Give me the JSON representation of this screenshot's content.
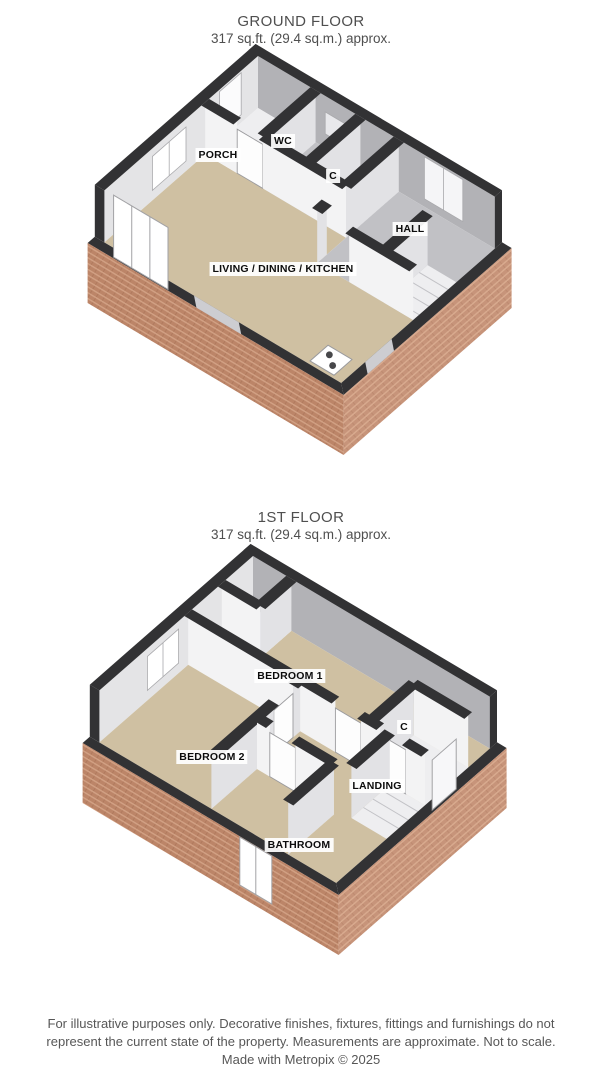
{
  "ground_floor": {
    "title": "GROUND FLOOR",
    "subtitle": "317 sq.ft. (29.4 sq.m.) approx.",
    "labels": [
      {
        "text": "PORCH",
        "x": 218,
        "y": 155
      },
      {
        "text": "WC",
        "x": 283,
        "y": 141
      },
      {
        "text": "C",
        "x": 333,
        "y": 176
      },
      {
        "text": "HALL",
        "x": 410,
        "y": 229
      },
      {
        "text": "LIVING / DINING / KITCHEN",
        "x": 283,
        "y": 269
      }
    ]
  },
  "first_floor": {
    "title": "1ST FLOOR",
    "subtitle": "317 sq.ft. (29.4 sq.m.) approx.",
    "labels": [
      {
        "text": "BEDROOM 1",
        "x": 290,
        "y": 676
      },
      {
        "text": "BEDROOM 2",
        "x": 212,
        "y": 757
      },
      {
        "text": "C",
        "x": 404,
        "y": 727
      },
      {
        "text": "LANDING",
        "x": 377,
        "y": 786
      },
      {
        "text": "BATHROOM",
        "x": 299,
        "y": 845
      }
    ]
  },
  "footer": {
    "line1": "For illustrative purposes only. Decorative finishes, fixtures, fittings and furnishings do not",
    "line2": "represent the current state of the property. Measurements are approximate. Not to scale.",
    "line3": "Made with Metropix © 2025"
  },
  "colors": {
    "dark": "#323234",
    "tan": "#cfc0a2",
    "floorGray": "#c1c1c5",
    "floorWhite": "#eeeef0",
    "neFace": "#b2b2b6",
    "nwFace": "#e4e4e6",
    "wallH": "#f3f3f4",
    "wallV": "#e2e2e5",
    "brickBase": "#c7947a",
    "brickLight": "#d9ab8f"
  },
  "plans": {
    "ground": {
      "origin": [
        258,
        108
      ],
      "size": [
        7.4,
        6.4
      ],
      "floors": [
        {
          "pts": [
            [
              0,
              2.2
            ],
            [
              4.4,
              2.2
            ],
            [
              4.4,
              3.4
            ],
            [
              7.4,
              3.4
            ],
            [
              7.4,
              6.4
            ],
            [
              0,
              6.4
            ]
          ],
          "fill": "tan"
        },
        {
          "pts": [
            [
              0,
              0
            ],
            [
              1.8,
              0
            ],
            [
              1.8,
              2.2
            ],
            [
              0,
              2.2
            ]
          ],
          "fill": "floorWhite"
        },
        {
          "pts": [
            [
              1.8,
              0
            ],
            [
              3.2,
              0
            ],
            [
              3.2,
              2.2
            ],
            [
              1.8,
              2.2
            ]
          ],
          "fill": "floorGray"
        },
        {
          "pts": [
            [
              3.2,
              0
            ],
            [
              4.4,
              0
            ],
            [
              4.4,
              2.2
            ],
            [
              3.2,
              2.2
            ]
          ],
          "fill": "floorGray"
        },
        {
          "pts": [
            [
              4.4,
              0
            ],
            [
              7.4,
              0
            ],
            [
              7.4,
              3.4
            ],
            [
              4.4,
              3.4
            ]
          ],
          "fill": "floorGray"
        },
        {
          "pts": [
            [
              6.5,
              1.6
            ],
            [
              7.4,
              1.6
            ],
            [
              7.4,
              3.4
            ],
            [
              6.5,
              3.4
            ]
          ],
          "fill": "floorWhite"
        }
      ],
      "treads": {
        "u1": 6.5,
        "u2": 7.4,
        "vs": [
          1.95,
          2.35,
          2.75,
          3.15
        ]
      },
      "insets": [
        {
          "wall": "NW",
          "f": 0.7,
          "t": 1.6,
          "y1": 50,
          "y2": 8,
          "fill": "#fbfbfc",
          "panes": 1
        },
        {
          "wall": "NW",
          "f": 3.0,
          "t": 4.4,
          "y1": 44,
          "y2": 10,
          "fill": "#ffffff",
          "panes": 2
        },
        {
          "wall": "NE",
          "f": 2.1,
          "t": 2.9,
          "y1": 36,
          "y2": 14,
          "fill": "#e8e8eb",
          "panes": 1
        },
        {
          "wall": "NE",
          "f": 5.2,
          "t": 6.4,
          "y1": 50,
          "y2": 8,
          "fill": "#f5f5f7",
          "panes": 2
        }
      ],
      "partitions": [
        {
          "a": [
            0,
            2.2
          ],
          "b": [
            1.0,
            2.2
          ],
          "k": "w"
        },
        {
          "a": [
            1.8,
            0
          ],
          "b": [
            1.8,
            2.2
          ],
          "k": "w"
        },
        {
          "a": [
            1.0,
            2.2
          ],
          "b": [
            1.8,
            2.2
          ],
          "k": "d"
        },
        {
          "a": [
            3.2,
            0
          ],
          "b": [
            3.2,
            2.2
          ],
          "k": "w"
        },
        {
          "a": [
            1.8,
            2.2
          ],
          "b": [
            4.4,
            2.2
          ],
          "k": "w"
        },
        {
          "a": [
            4.4,
            0
          ],
          "b": [
            4.4,
            2.2
          ],
          "k": "w"
        },
        {
          "a": [
            4.4,
            3.0
          ],
          "b": [
            4.4,
            3.4
          ],
          "k": "w"
        },
        {
          "a": [
            6.5,
            1.6
          ],
          "b": [
            6.5,
            3.4
          ],
          "k": "w"
        },
        {
          "a": [
            5.4,
            3.4
          ],
          "b": [
            7.4,
            3.4
          ],
          "k": "w"
        }
      ],
      "stands": [
        {
          "side": "SW",
          "f": 0.4,
          "t": 2.1,
          "h": 58,
          "dir": "up",
          "panes": 3,
          "fill": "#ffffff"
        }
      ],
      "strips": [
        {
          "side": "SW",
          "f": 2.8,
          "t": 4.2
        },
        {
          "side": "SE",
          "f": 4.3,
          "t": 5.4
        }
      ],
      "cooker": {
        "pts": [
          [
            6.35,
            5.55
          ],
          [
            7.1,
            5.55
          ],
          [
            7.1,
            6.3
          ],
          [
            6.35,
            6.3
          ]
        ],
        "burners": [
          [
            6.58,
            5.8
          ],
          [
            6.87,
            6.05
          ]
        ]
      }
    },
    "first": {
      "origin": [
        253,
        608
      ],
      "size": [
        7.4,
        6.4
      ],
      "floors": [
        {
          "pts": [
            [
              1.2,
              0
            ],
            [
              7.4,
              0
            ],
            [
              7.4,
              0.9
            ],
            [
              5.7,
              0.9
            ],
            [
              5.7,
              2.7
            ],
            [
              0,
              2.7
            ],
            [
              0,
              1.3
            ],
            [
              1.2,
              1.3
            ]
          ],
          "fill": "tan"
        },
        {
          "pts": [
            [
              0,
              0
            ],
            [
              1.2,
              0
            ],
            [
              1.2,
              1.3
            ],
            [
              0,
              1.3
            ]
          ],
          "fill": "floorWhite"
        },
        {
          "pts": [
            [
              5.7,
              0.9
            ],
            [
              7.4,
              0.9
            ],
            [
              7.4,
              2.7
            ],
            [
              5.7,
              2.7
            ]
          ],
          "fill": "floorWhite"
        },
        {
          "pts": [
            [
              0,
              2.7
            ],
            [
              3.5,
              2.7
            ],
            [
              3.5,
              6.4
            ],
            [
              0,
              6.4
            ]
          ],
          "fill": "tan"
        },
        {
          "pts": [
            [
              3.5,
              2.7
            ],
            [
              7.4,
              2.7
            ],
            [
              7.4,
              6.4
            ],
            [
              5.9,
              6.4
            ],
            [
              5.9,
              4.5
            ],
            [
              3.5,
              4.5
            ]
          ],
          "fill": "tan"
        },
        {
          "pts": [
            [
              6.3,
              2.7
            ],
            [
              7.4,
              2.7
            ],
            [
              7.4,
              4.3
            ],
            [
              6.3,
              4.3
            ]
          ],
          "fill": "floorWhite"
        },
        {
          "pts": [
            [
              3.5,
              4.5
            ],
            [
              5.9,
              4.5
            ],
            [
              5.9,
              6.4
            ],
            [
              3.5,
              6.4
            ]
          ],
          "fill": "tan"
        }
      ],
      "treads": {
        "u1": 6.3,
        "u2": 7.4,
        "vs": [
          3.0,
          3.4,
          3.8
        ]
      },
      "insets": [
        {
          "wall": "NW",
          "f": 3.1,
          "t": 4.4,
          "y1": 44,
          "y2": 10,
          "fill": "#ffffff",
          "panes": 2
        }
      ],
      "partitions": [
        {
          "a": [
            1.2,
            0
          ],
          "b": [
            1.2,
            1.3
          ],
          "k": "w"
        },
        {
          "a": [
            0,
            1.3
          ],
          "b": [
            1.2,
            1.3
          ],
          "k": "w"
        },
        {
          "a": [
            0,
            2.7
          ],
          "b": [
            4.6,
            2.7
          ],
          "k": "w"
        },
        {
          "a": [
            4.6,
            2.7
          ],
          "b": [
            5.4,
            2.7
          ],
          "k": "d"
        },
        {
          "a": [
            5.7,
            0.9
          ],
          "b": [
            7.4,
            0.9
          ],
          "k": "w"
        },
        {
          "a": [
            5.7,
            0.9
          ],
          "b": [
            5.7,
            2.7
          ],
          "k": "w"
        },
        {
          "a": [
            5.4,
            2.7
          ],
          "b": [
            6.0,
            2.7
          ],
          "k": "w"
        },
        {
          "a": [
            6.0,
            2.7
          ],
          "b": [
            6.8,
            2.7
          ],
          "k": "d"
        },
        {
          "a": [
            6.8,
            2.7
          ],
          "b": [
            7.4,
            2.7
          ],
          "k": "w"
        },
        {
          "a": [
            3.5,
            2.7
          ],
          "b": [
            3.5,
            3.0
          ],
          "k": "w"
        },
        {
          "a": [
            3.5,
            3.0
          ],
          "b": [
            3.5,
            3.8
          ],
          "k": "d"
        },
        {
          "a": [
            3.5,
            3.8
          ],
          "b": [
            3.5,
            6.4
          ],
          "k": "w"
        },
        {
          "a": [
            3.5,
            4.5
          ],
          "b": [
            3.9,
            4.5
          ],
          "k": "w"
        },
        {
          "a": [
            3.9,
            4.5
          ],
          "b": [
            4.7,
            4.5
          ],
          "k": "d"
        },
        {
          "a": [
            4.7,
            4.5
          ],
          "b": [
            5.9,
            4.5
          ],
          "k": "w"
        },
        {
          "a": [
            6.3,
            2.7
          ],
          "b": [
            6.3,
            4.3
          ],
          "k": "w"
        },
        {
          "a": [
            5.9,
            4.5
          ],
          "b": [
            5.9,
            6.4
          ],
          "k": "w"
        }
      ],
      "stands": [
        {
          "side": "SE",
          "f": 1.6,
          "t": 2.6,
          "h": 46,
          "dir": "up",
          "panes": 0,
          "fill": "#f7f7f9"
        },
        {
          "side": "SW",
          "f": 4.5,
          "t": 5.5,
          "h": 48,
          "dir": "down",
          "panes": 2,
          "fill": "#ffffff"
        }
      ],
      "strips": []
    }
  }
}
